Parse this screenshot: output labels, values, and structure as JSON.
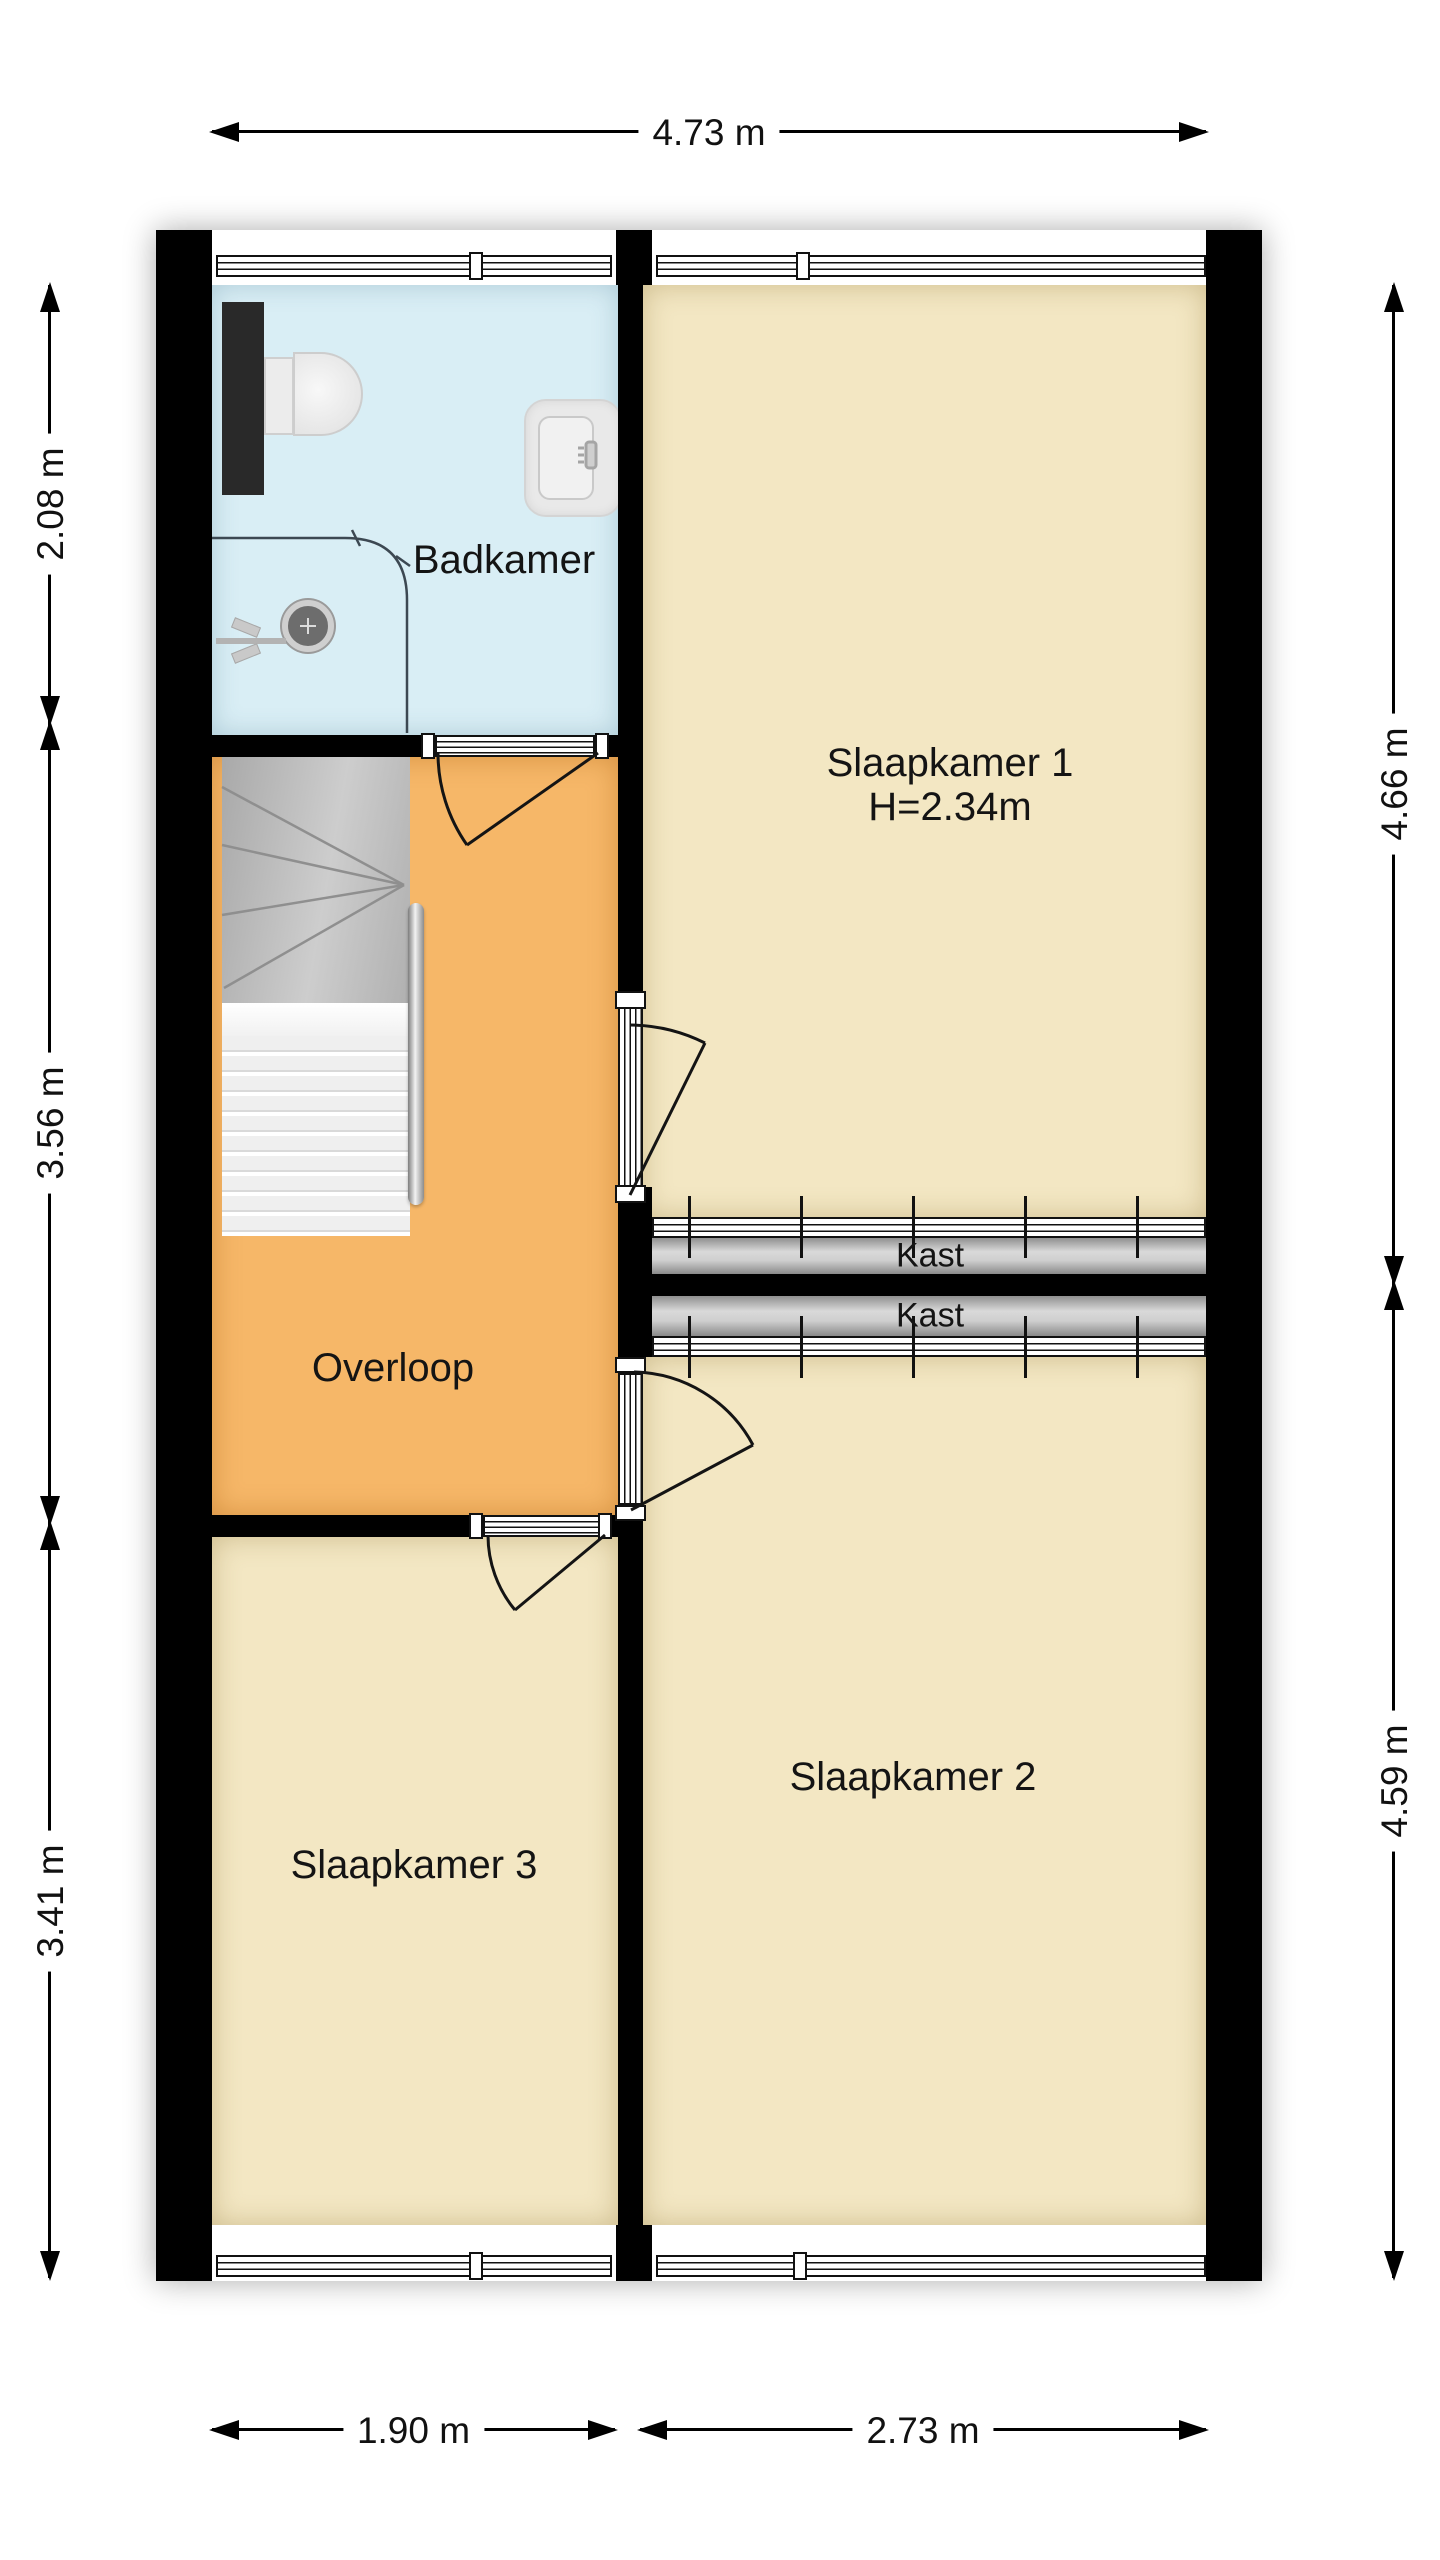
{
  "plan": {
    "type": "floorplan-first-floor",
    "rooms": {
      "badkamer": {
        "label": "Badkamer"
      },
      "slaapkamer1": {
        "label": "Slaapkamer 1",
        "height_note": "H=2.34m"
      },
      "overloop": {
        "label": "Overloop"
      },
      "kast_boven": {
        "label": "Kast"
      },
      "kast_onder": {
        "label": "Kast"
      },
      "slaapkamer2": {
        "label": "Slaapkamer 2"
      },
      "slaapkamer3": {
        "label": "Slaapkamer 3"
      }
    },
    "dimensions": {
      "top_total_width": "4.73 m",
      "left_badkamer": "2.08 m",
      "left_overloop": "3.56 m",
      "left_slaapkamer3": "3.41 m",
      "right_slaapkamer1": "4.66 m",
      "right_slaapkamer2": "4.59 m",
      "bottom_slaapkamer3": "1.90 m",
      "bottom_slaapkamer2": "2.73 m"
    },
    "fixtures": {
      "bathroom": [
        "toilet-icon",
        "shower-tray-icon",
        "sink-icon",
        "faucet-icon",
        "shower-area-line"
      ],
      "hall": [
        "stairs-icon",
        "handrail"
      ],
      "doors": [
        "badkamer-door",
        "slaapkamer1-door",
        "slaapkamer2-door",
        "slaapkamer3-door"
      ],
      "windows": [
        "badkamer-window",
        "slaapkamer1-window",
        "slaapkamer2-window",
        "slaapkamer3-window"
      ],
      "closets": [
        "kast-sliding-doors-top",
        "kast-sliding-doors-bottom"
      ]
    },
    "colors": {
      "wall": "#000000",
      "badkamer_floor": "#d9eef5",
      "bedroom_floor": "#f3e7c3",
      "overloop_floor": "#f6b768",
      "kast_fill": "#c9c9c9",
      "stairs_gray": "#b5b5b5",
      "symbol_white": "#ffffff",
      "text": "#141414"
    }
  }
}
